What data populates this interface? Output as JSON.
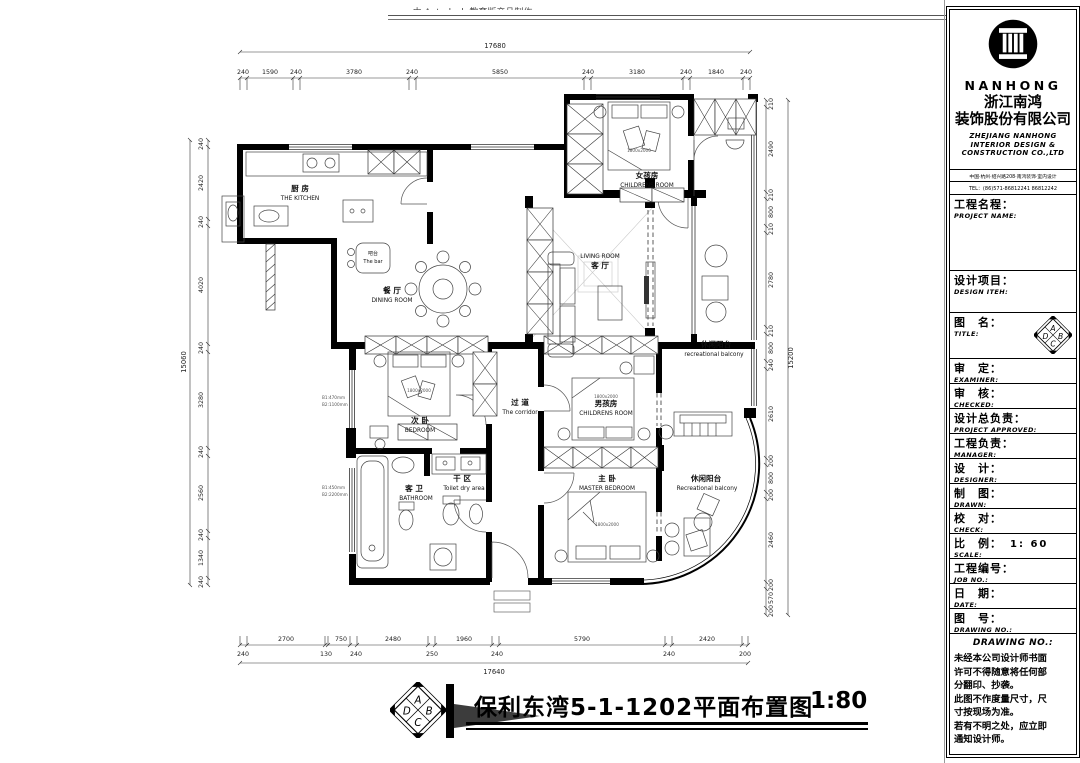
{
  "watermark": {
    "text": "由 Autodesk 教育版产品制作"
  },
  "plan": {
    "rooms": {
      "kitchen": {
        "zh": "厨 房",
        "en": "THE KITCHEN"
      },
      "bar": {
        "zh": "吧台",
        "en": "The bar"
      },
      "dining": {
        "zh": "餐 厅",
        "en": "DINING ROOM"
      },
      "living": {
        "en": "LIVING ROOM",
        "zh": "客 厅"
      },
      "girls_room": {
        "zh": "女孩房",
        "en": "CHILDRENS ROOM"
      },
      "boys_room": {
        "zh": "男孩房",
        "en": "CHILDRENS ROOM"
      },
      "bedroom": {
        "zh": "次 卧",
        "en": "BEDROOM"
      },
      "corridor": {
        "zh": "过 道",
        "en": "The corridor"
      },
      "dry_area": {
        "zh": "干 区",
        "en": "Toilet dry area"
      },
      "bathroom": {
        "zh": "客 卫",
        "en": "BATHROOM"
      },
      "master": {
        "zh": "主 卧",
        "en": "MASTER BEDROOM"
      },
      "balcony_top": {
        "zh": "休闲阳台",
        "en": "recreational balcony"
      },
      "balcony_bottom": {
        "zh": "休闲阳台",
        "en": "Recreational balcony"
      }
    },
    "bed_size_label": "1800x2000",
    "annotations": {
      "a1": "B1:470mm",
      "a2": "B2:1100mm",
      "a3": "B1:450mm",
      "a4": "B2:2200mm"
    }
  },
  "dims": {
    "top": {
      "overall": "17680",
      "segments": [
        "240",
        "1590",
        "240",
        "3780",
        "240",
        "5850",
        "240",
        "3180",
        "240",
        "1840",
        "240"
      ]
    },
    "bottom": {
      "overall": "17640",
      "segments": [
        "240",
        "2700",
        "130",
        "750",
        "240",
        "2480",
        "250",
        "1960",
        "240",
        "5790",
        "240",
        "2420",
        "200"
      ]
    },
    "left": {
      "overall": "15060",
      "segments": [
        "240",
        "2420",
        "240",
        "4020",
        "240",
        "3280",
        "240",
        "2560",
        "240",
        "1340",
        "240"
      ]
    },
    "right": {
      "overall": "15200",
      "segments": [
        "210",
        "2490",
        "210",
        "800",
        "210",
        "2780",
        "210",
        "800",
        "240",
        "2610",
        "200",
        "800",
        "200",
        "2460",
        "200",
        "570",
        "200"
      ]
    }
  },
  "title_bar": {
    "title": "保利东湾5-1-1202平面布置图",
    "scale": "1:80",
    "logo_letters": [
      "A",
      "D",
      "B",
      "C"
    ]
  },
  "panel": {
    "brand": {
      "name": "NANHONG",
      "company_zh1": "浙江南鸿",
      "company_zh2": "装饰股份有限公司",
      "company_en1": "ZHEJIANG NANHONG",
      "company_en2": "INTERIOR DESIGN &",
      "company_en3": "CONSTRUCTION CO.,LTD",
      "address": "中国·杭州·绍兴路208·南鸿装饰·室内设计",
      "tel": "TEL：(86)571-86812241  86812242"
    },
    "fields": [
      {
        "zh": "工程名程：",
        "en": "PROJECT NAME:"
      },
      {
        "zh": "设计项目：",
        "en": "DESIGN ITEH:"
      },
      {
        "zh": "图　名：",
        "en": "TITLE:"
      },
      {
        "zh": "审　定：",
        "en": "EXAMINER:"
      },
      {
        "zh": "审　核：",
        "en": "CHECKED:"
      },
      {
        "zh": "设计总负责：",
        "en": "PROJECT APPROVED:"
      },
      {
        "zh": "工程负责：",
        "en": "MANAGER:"
      },
      {
        "zh": "设　计：",
        "en": "DESIGNER:"
      },
      {
        "zh": "制　图：",
        "en": "DRAWN:"
      },
      {
        "zh": "校　对：",
        "en": "CHECK:"
      },
      {
        "zh": "比　例：",
        "en": "SCALE:",
        "value": "1: 60"
      },
      {
        "zh": "工程编号：",
        "en": "JOB  NO.:"
      },
      {
        "zh": "日　期：",
        "en": "DATE:"
      },
      {
        "zh": "图　号：",
        "en": "DRAWING NO.:"
      }
    ],
    "drawing_no_header": "DRAWING NO.:",
    "notice_lines": [
      "未经本公司设计师书面",
      "许可不得随意将任何部",
      "分翻印、抄袭。",
      "此图不作度量尺寸，尺",
      "寸按现场为准。",
      "若有不明之处，应立即",
      "通知设计师。"
    ]
  }
}
